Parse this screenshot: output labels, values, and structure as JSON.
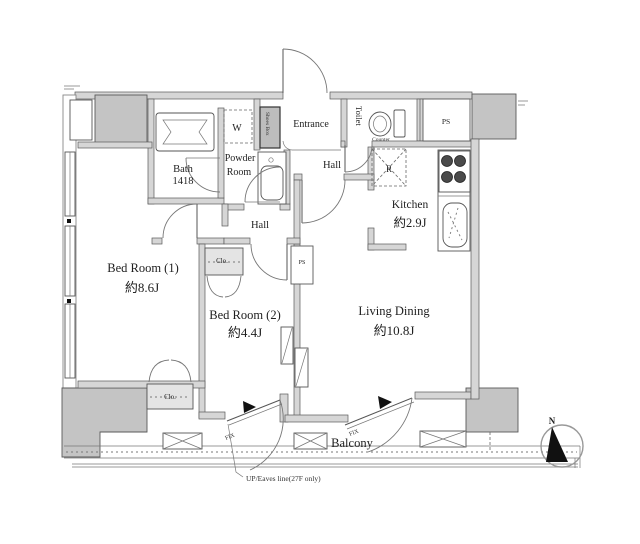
{
  "colors": {
    "wall": "#d6d6d6",
    "column": "#c4c4c4",
    "line": "#5a5a5a",
    "text": "#1e1e1e"
  },
  "rooms": {
    "bath": {
      "name": "Bath",
      "size": "1418"
    },
    "washer": {
      "label": "W"
    },
    "powder_room": {
      "name1": "Powder",
      "name2": "Room"
    },
    "entrance": {
      "label": "Entrance"
    },
    "shoes_box": {
      "label": "Shoes Box"
    },
    "toilet": {
      "label": "Toilet",
      "counter": "Counter"
    },
    "hall_upper": {
      "label": "Hall"
    },
    "hall_lower": {
      "label": "Hall"
    },
    "kitchen": {
      "name": "Kitchen",
      "size": "約2.9J",
      "fridge": "R"
    },
    "bedroom1": {
      "name": "Bed Room (1)",
      "size": "約8.6J"
    },
    "bedroom2": {
      "name": "Bed Room (2)",
      "size": "約4.4J"
    },
    "living_dining": {
      "name": "Living Dining",
      "size": "約10.8J"
    },
    "closet1": {
      "label": "Clo."
    },
    "closet2": {
      "label": "Clo."
    },
    "ps_top": {
      "label": "PS"
    },
    "ps_mid": {
      "label": "PS"
    },
    "balcony": {
      "label": "Balcony",
      "fix1": "FIX",
      "fix2": "FIX"
    }
  },
  "annotations": {
    "eaves_note": "UP/Eaves line(27F only)",
    "north": "N"
  }
}
